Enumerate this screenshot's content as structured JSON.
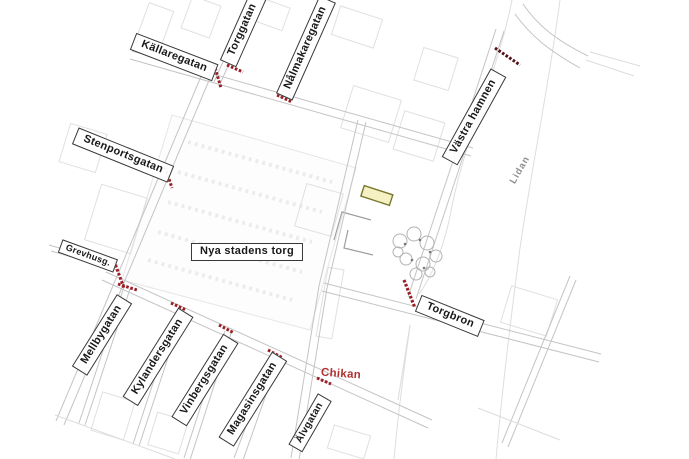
{
  "map": {
    "street_labels": {
      "kallaregatan": "Källaregatan",
      "torggatan": "Torggatan",
      "nalmakaregatan": "Nålmakaregatan",
      "stenportsgatan": "Stenportsgatan",
      "grevhusg": "Grevhusg.",
      "nya_stadens_torg": "Nya stadens torg",
      "mellbygatan": "Mellbygatan",
      "kylandersgatan": "Kylandersgatan",
      "vinbergsgatan": "Vinbergsgatan",
      "magasinsgatan": "Magasinsgatan",
      "alvgatan": "Älvgatan",
      "torgbron": "Torgbron",
      "vastra_hamnen": "Västra hamnen"
    },
    "annotations": {
      "chikan": "Chikan",
      "lidan": "Lidan"
    },
    "colors": {
      "street_gray": "#c4c4c4",
      "label_border": "#383838",
      "marker_red": "#9b1e24",
      "marker_dark_red": "#571317",
      "chikan_red": "#b23030",
      "river_label_gray": "#8f8f8f",
      "highlight_fill": "#f6f1c3",
      "highlight_stroke": "#77772e"
    }
  }
}
